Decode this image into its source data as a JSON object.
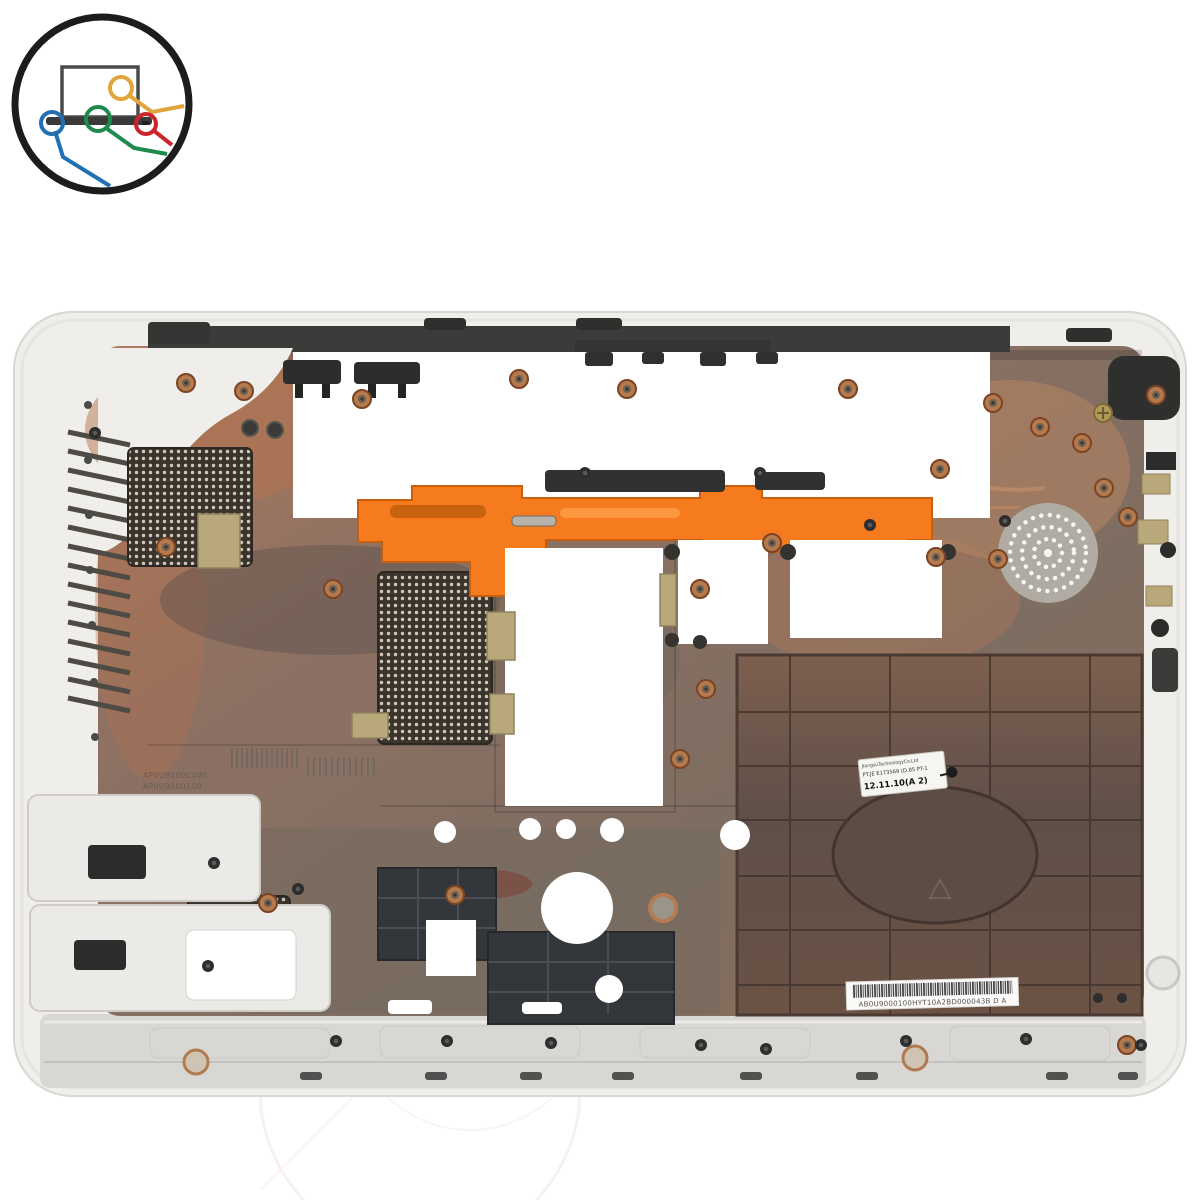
{
  "meta": {
    "type": "product-photo",
    "subject": "White laptop bottom base cover photographed from the inside, copper EMI coated interior, orange bracket, vent grilles, speaker grille",
    "background_color": "#ffffff"
  },
  "logo": {
    "name": "laptop-cables-logo",
    "outline_color": "#1c1c1c",
    "wire_colors": {
      "yellow": "#e2a43c",
      "red": "#cb262c",
      "green": "#1f8a4d",
      "blue": "#2170b4"
    }
  },
  "part_colors": {
    "outer_plastic": "#f0eeea",
    "copper_coating": "#a8765b",
    "accent_orange": "#f57b1e",
    "hinge_strip": "#d8d7d4",
    "grid_panel": "#6b5546"
  },
  "labels": {
    "qc_sticker": {
      "line1": "JiangsuTechnologyCo.Ltd",
      "line2": "PT.JE  E173569  (D.85  PT-1",
      "line3": "12.11.10(A  2)"
    },
    "barcode_label": {
      "text": "AB0U9000100HYT10A2BD000043B  D A"
    },
    "molded_marks": {
      "line1": "AP0U9000C400",
      "line2": "AP0U9000100",
      "line3": "08T08-B65-10W",
      "line4": "PC+ABS-T01 GF(40)",
      "line5": "Bayer FR3021",
      "line6": "BEAO F1346",
      "line7": "P/REF A0ST000300",
      "line8": "P/REF A0U9000100"
    }
  }
}
